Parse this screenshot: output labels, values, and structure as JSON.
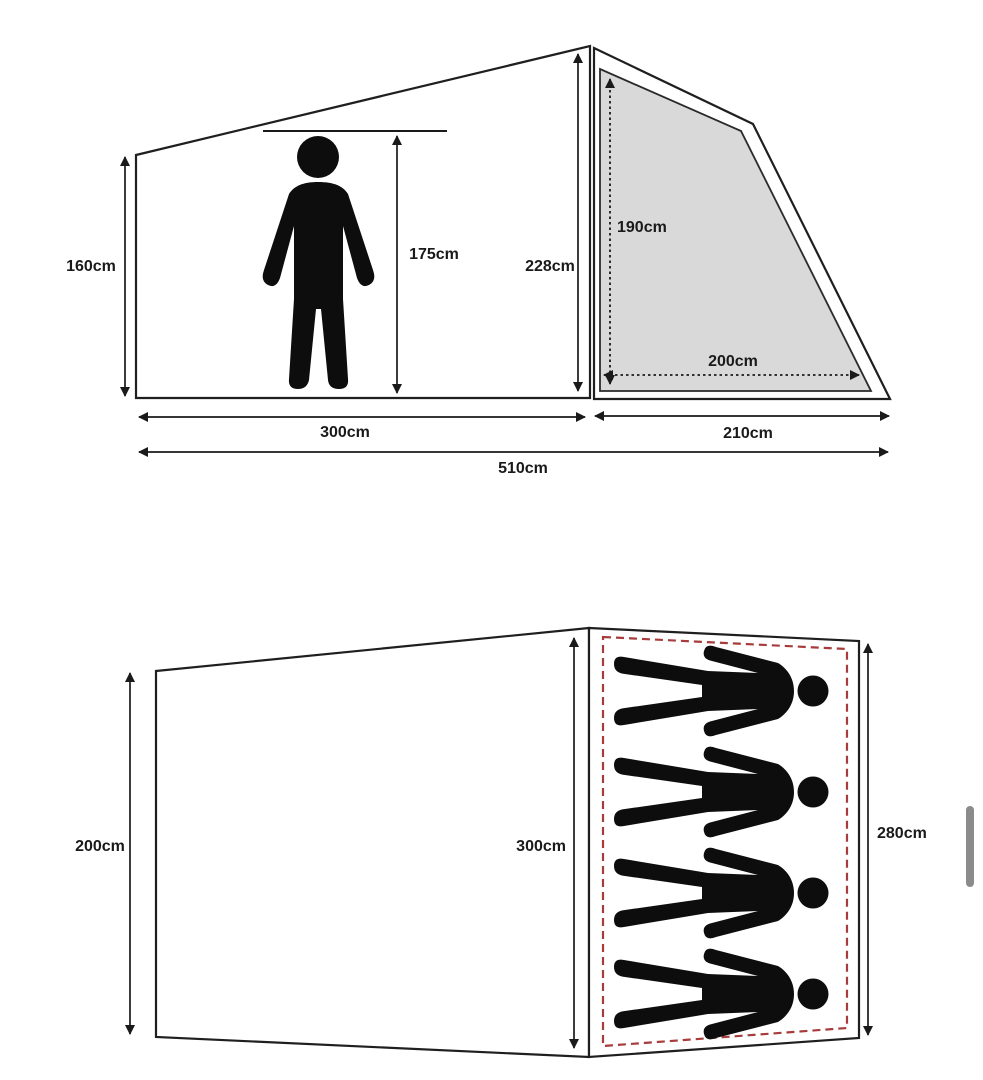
{
  "side_view": {
    "left_wall_height": "160cm",
    "person_height": "175cm",
    "peak_height": "228cm",
    "door_height": "190cm",
    "door_width": "200cm",
    "cabin_length": "300cm",
    "porch_length": "210cm",
    "total_length": "510cm"
  },
  "floor_plan": {
    "rear_width": "200cm",
    "cabin_width": "300cm",
    "sleeping_area_width": "280cm",
    "sleeping_capacity": 4
  },
  "colors": {
    "line": "#1f1f1f",
    "door_panel_fill": "#d9d9d9",
    "sleeping_area_dash": "#a83c3c",
    "silhouette": "#0d0d0d",
    "scrollbar": "#8b8b8b",
    "background": "#ffffff"
  }
}
